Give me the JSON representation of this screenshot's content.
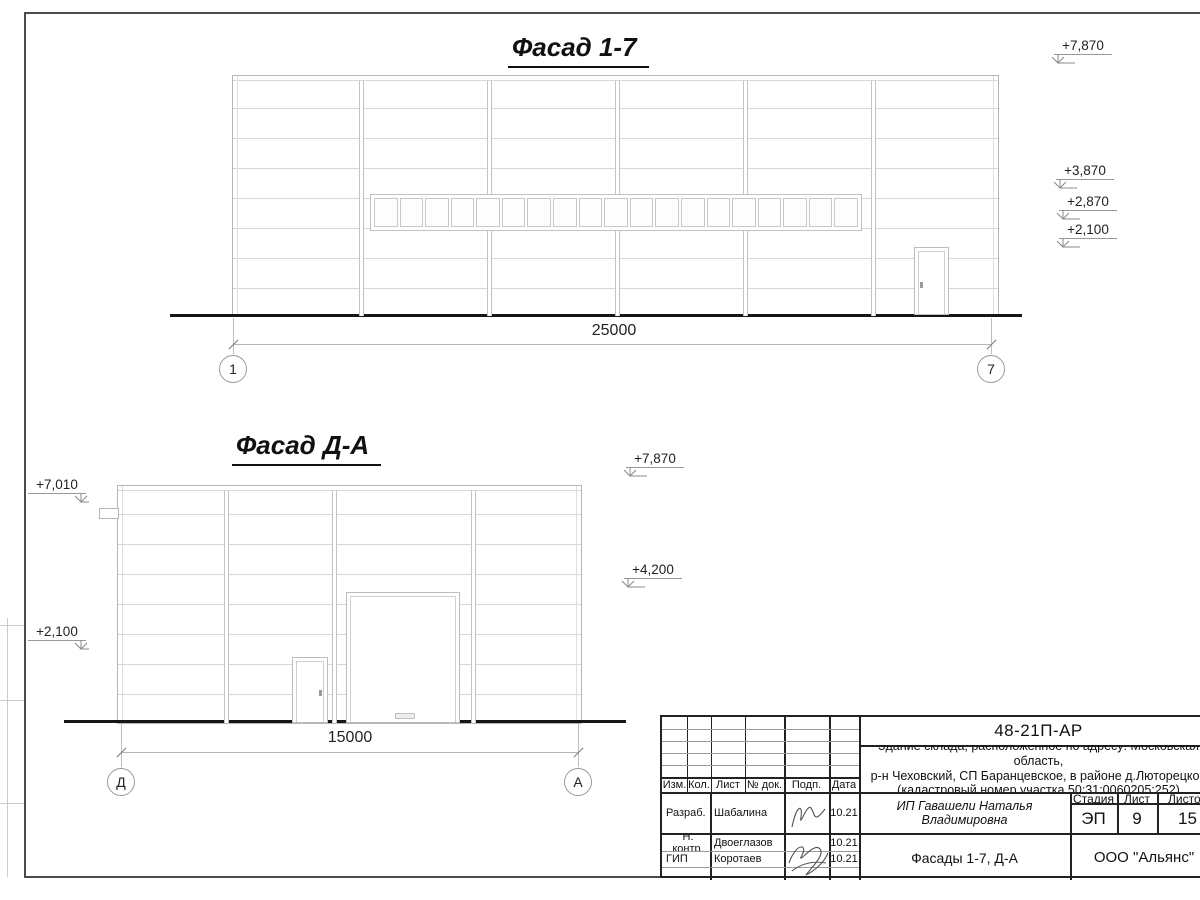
{
  "drawing": {
    "facade1": {
      "title": "Фасад 1-7",
      "dim": "25000",
      "axis_left": "1",
      "axis_right": "7",
      "window_panes": 19,
      "elevations": [
        {
          "label": "+7,870"
        },
        {
          "label": "+3,870"
        },
        {
          "label": "+2,870"
        },
        {
          "label": "+2,100"
        }
      ]
    },
    "facade2": {
      "title": "Фасад Д-А",
      "dim": "15000",
      "axis_left": "Д",
      "axis_right": "А",
      "elevations_left": [
        {
          "label": "+7,010"
        },
        {
          "label": "+2,100"
        }
      ],
      "elevations_right": [
        {
          "label": "+7,870"
        },
        {
          "label": "+4,200"
        }
      ]
    }
  },
  "titleblock": {
    "doc_number": "48-21П-АР",
    "address_line1": "Здание склада, расположенное по адресу: Московская область,",
    "address_line2": "р-н Чеховский, СП Баранцевское, в районе д.Люторецкое",
    "address_line3": "(кадастровый номер участка 50:31:0060205:252)",
    "header_cols": [
      "Изм.",
      "Кол.",
      "Лист",
      "№ док.",
      "Подп.",
      "Дата"
    ],
    "rows": [
      {
        "role": "Разраб.",
        "name": "Шабалина",
        "date": "10.21"
      },
      {
        "role": "Н. контр.",
        "name": "Двоеглазов",
        "date": "10.21"
      },
      {
        "role": "ГИП",
        "name": "Коротаев",
        "date": "10.21"
      }
    ],
    "client": "ИП Гавашели Наталья Владимировна",
    "stage_label": "Стадия",
    "sheet_label": "Лист",
    "sheets_label": "Листов",
    "stage": "ЭП",
    "sheet": "9",
    "sheets": "15",
    "sheet_title": "Фасады 1-7, Д-А",
    "company": "ООО \"Альянс\""
  }
}
